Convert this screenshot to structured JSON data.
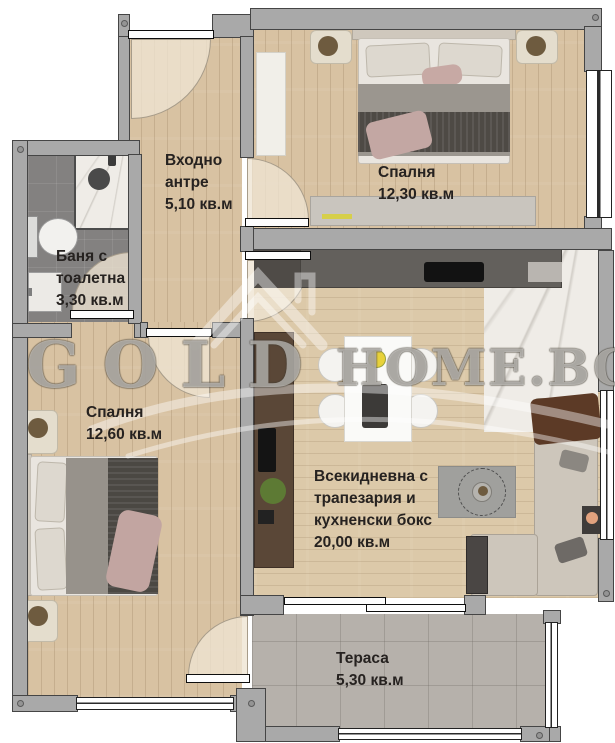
{
  "watermark": {
    "left_text": "GOLD",
    "right_text": "HOME.BG"
  },
  "rooms": {
    "hall": {
      "line1": "Входно",
      "line2": "антре",
      "area": "5,10 кв.м"
    },
    "bedroom1": {
      "line1": "Спалня",
      "area": "12,30 кв.м"
    },
    "bathroom": {
      "line1": "Баня с",
      "line2": "тоалетна",
      "area": "3,30 кв.м"
    },
    "bedroom2": {
      "line1": "Спалня",
      "area": "12,60 кв.м"
    },
    "living": {
      "line1": "Всекидневна с",
      "line2": "трапезария и",
      "line3": "кухненски бокс",
      "area": "20,00 кв.м"
    },
    "terrace": {
      "line1": "Тераса",
      "area": "5,30 кв.м"
    }
  },
  "colors": {
    "wall": "#a9a9a9",
    "wood_floor": "#d8c2a2",
    "bath_tile": "#838180",
    "terrace_tile": "#b6b1ab",
    "label_text": "#262220",
    "kitchen_counter": "#63605c",
    "tv_unit": "#5a4737",
    "sofa": "#cdc6bb",
    "sofa_throw": "#5c3a26",
    "watermark": "rgba(255,255,255,0.48)"
  }
}
